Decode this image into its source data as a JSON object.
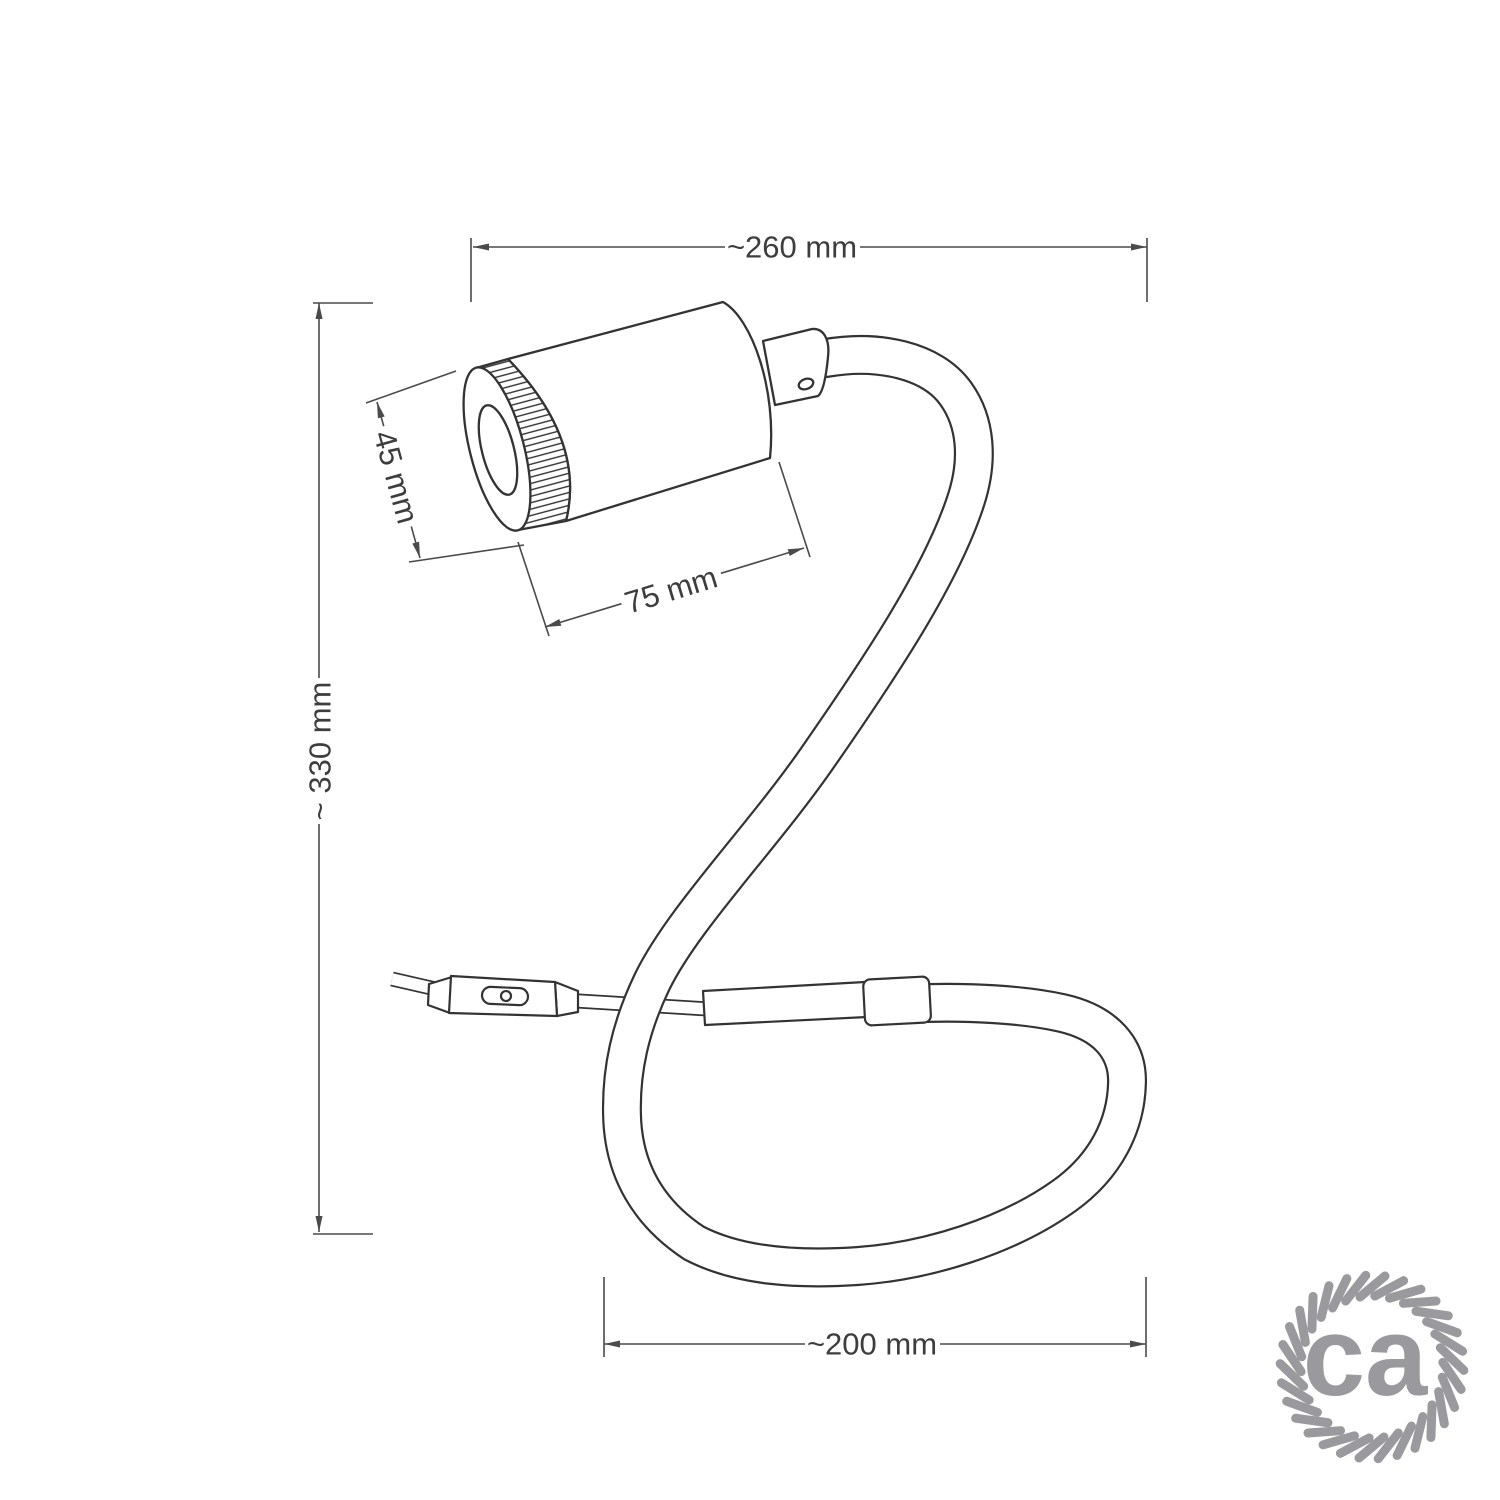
{
  "diagram": {
    "title": "gooseneck-lamp-dimension-drawing",
    "dimensions": {
      "width_top": "~260 mm",
      "height_left": "~ 330 mm",
      "spot_diameter": "45 mm",
      "spot_length": "75 mm",
      "base_width": "~200 mm"
    },
    "logo": {
      "text": "ca"
    },
    "colors": {
      "drawing_line": "#333333",
      "dimension_line": "#4a4a4a",
      "logo_gray": "#9a9a9e",
      "background": "#ffffff"
    }
  }
}
